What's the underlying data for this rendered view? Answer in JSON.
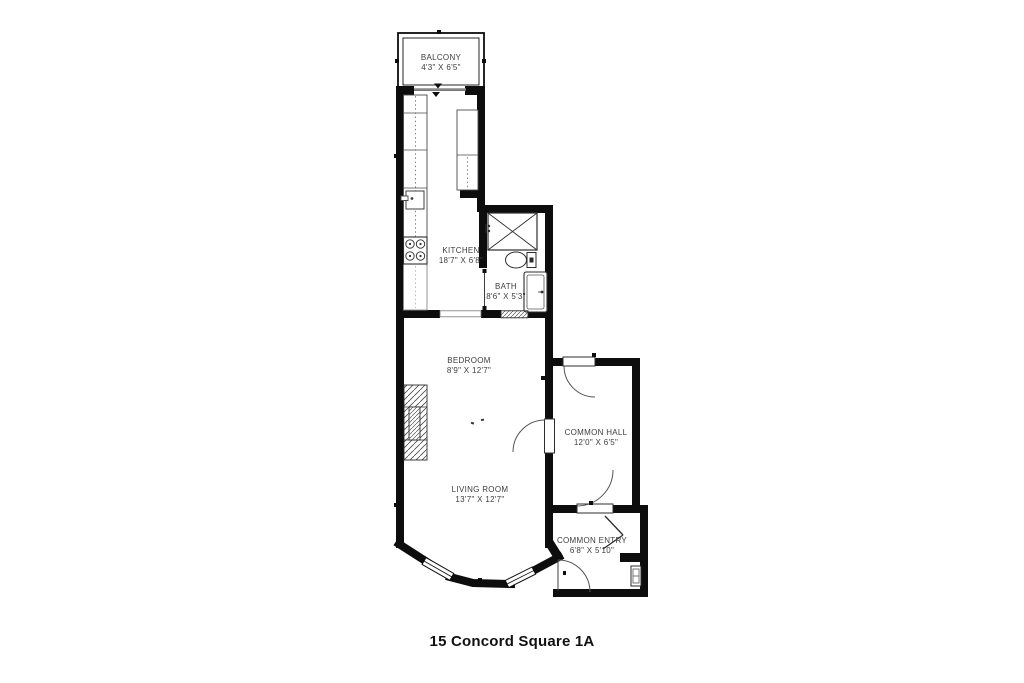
{
  "title": "15 Concord Square 1A",
  "colors": {
    "wall": "#0d0d0d",
    "floor": "#ffffff",
    "label_text": "#3d3d3d"
  },
  "rooms": [
    {
      "id": "balcony",
      "name": "BALCONY",
      "dims": "4'3\" X 6'5\""
    },
    {
      "id": "kitchen",
      "name": "KITCHEN",
      "dims": "18'7\" X 6'8\""
    },
    {
      "id": "bath",
      "name": "BATH",
      "dims": "8'6\" X 5'3\""
    },
    {
      "id": "bedroom",
      "name": "BEDROOM",
      "dims": "8'9\" X 12'7\""
    },
    {
      "id": "living-room",
      "name": "LIVING ROOM",
      "dims": "13'7\" X 12'7\""
    },
    {
      "id": "common-hall",
      "name": "COMMON HALL",
      "dims": "12'0\" X 6'5\""
    },
    {
      "id": "common-entry",
      "name": "COMMON ENTRY",
      "dims": "6'8\" X 5'10\""
    }
  ],
  "fixtures": [
    "balcony-railing",
    "sliding-door",
    "kitchen-counter",
    "kitchen-sink",
    "stove",
    "shower",
    "toilet",
    "vanity-sink",
    "radiator",
    "fireplace",
    "bay-window",
    "door-swing",
    "electrical-panel",
    "entry-door"
  ]
}
